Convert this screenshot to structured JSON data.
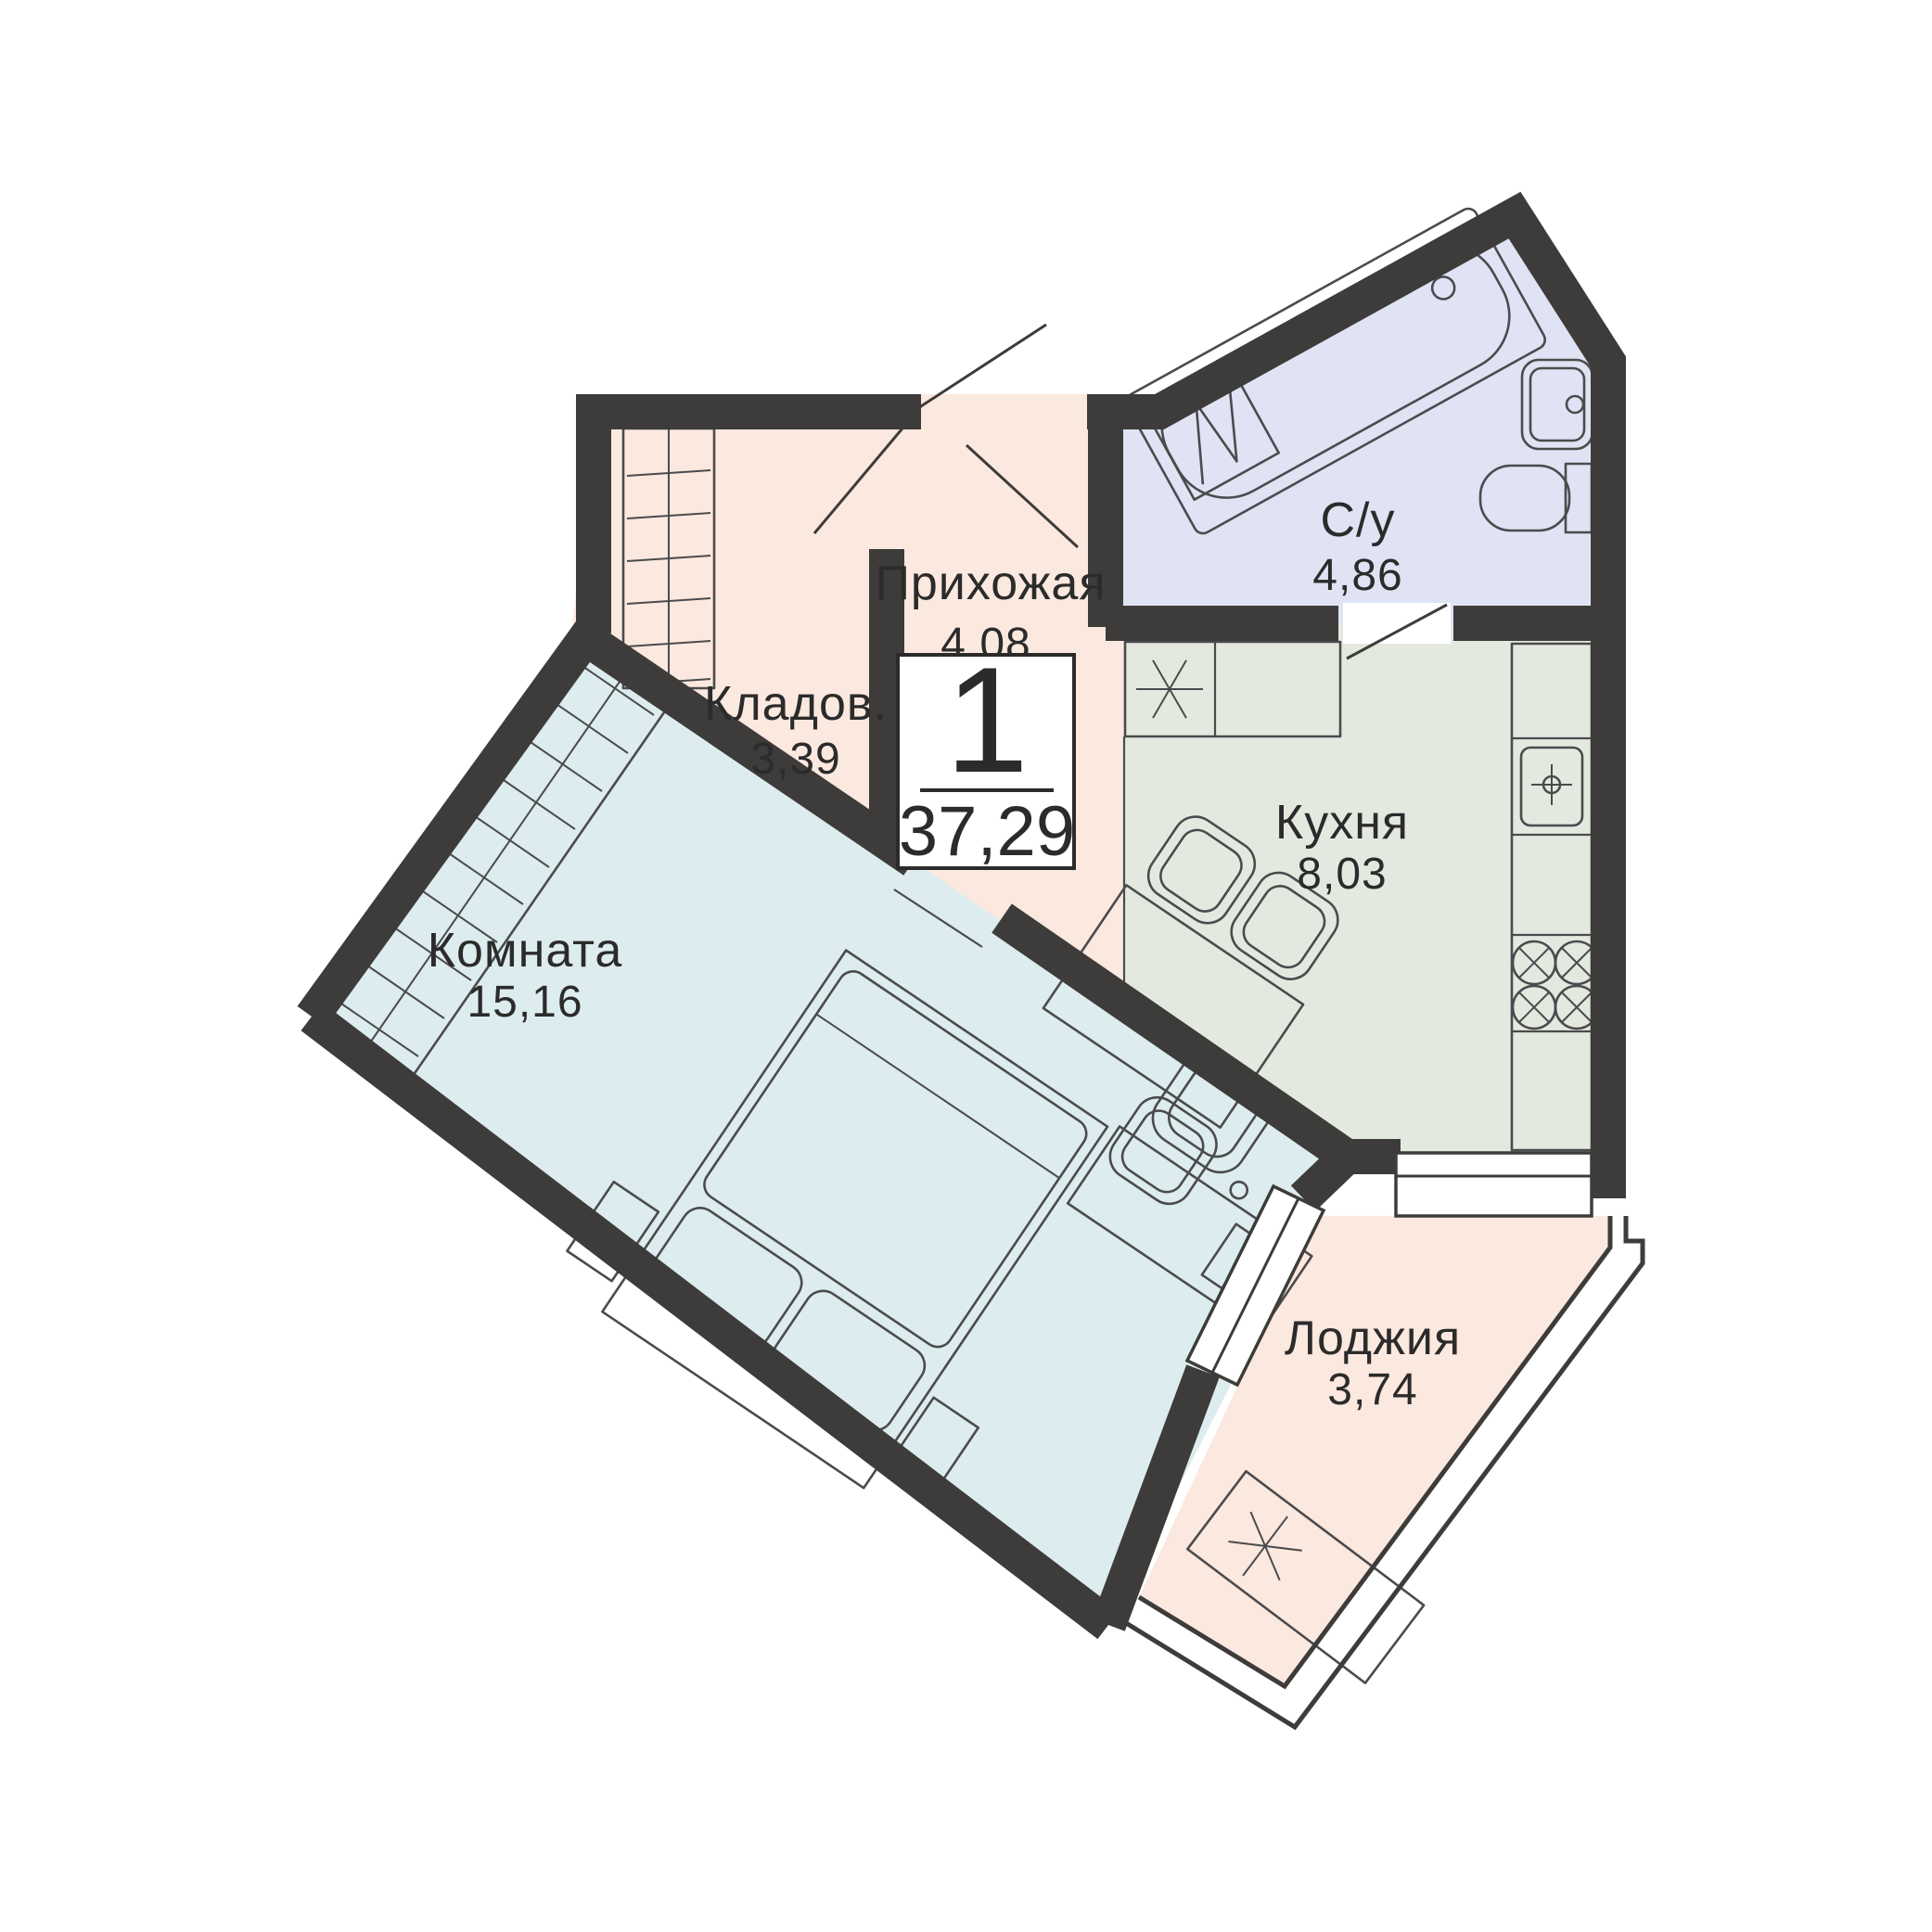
{
  "plan": {
    "title": "Floor plan — 1-room apartment",
    "unit_badge": {
      "rooms_count": "1",
      "total_area": "37,29"
    },
    "rooms": [
      {
        "id": "hallway",
        "label": "Прихожая",
        "area": "4,08"
      },
      {
        "id": "storage",
        "label": "Кладов.",
        "area": "3,39"
      },
      {
        "id": "bathroom",
        "label": "С/у",
        "area": "4,86"
      },
      {
        "id": "kitchen",
        "label": "Кухня",
        "area": "8,03"
      },
      {
        "id": "living-room",
        "label": "Комната",
        "area": "15,16"
      },
      {
        "id": "loggia",
        "label": "Лоджия",
        "area": "3,74"
      }
    ],
    "icons": {
      "asterisk_kitchen": "washing-machine-place-icon",
      "asterisk_loggia": "ac-unit-place-icon",
      "crosshair": "sink-faucet-icon",
      "burner_cross": "stove-burner-icon"
    },
    "colors": {
      "wall": "#3d3c3a",
      "hallway": "#fbe8df",
      "bathroom": "#dfe3f3",
      "kitchen": "#e4e9e0",
      "room": "#ddecee",
      "loggia": "#fbe8df",
      "line": "#4b4b4d",
      "text": "#2b2b2b"
    }
  }
}
